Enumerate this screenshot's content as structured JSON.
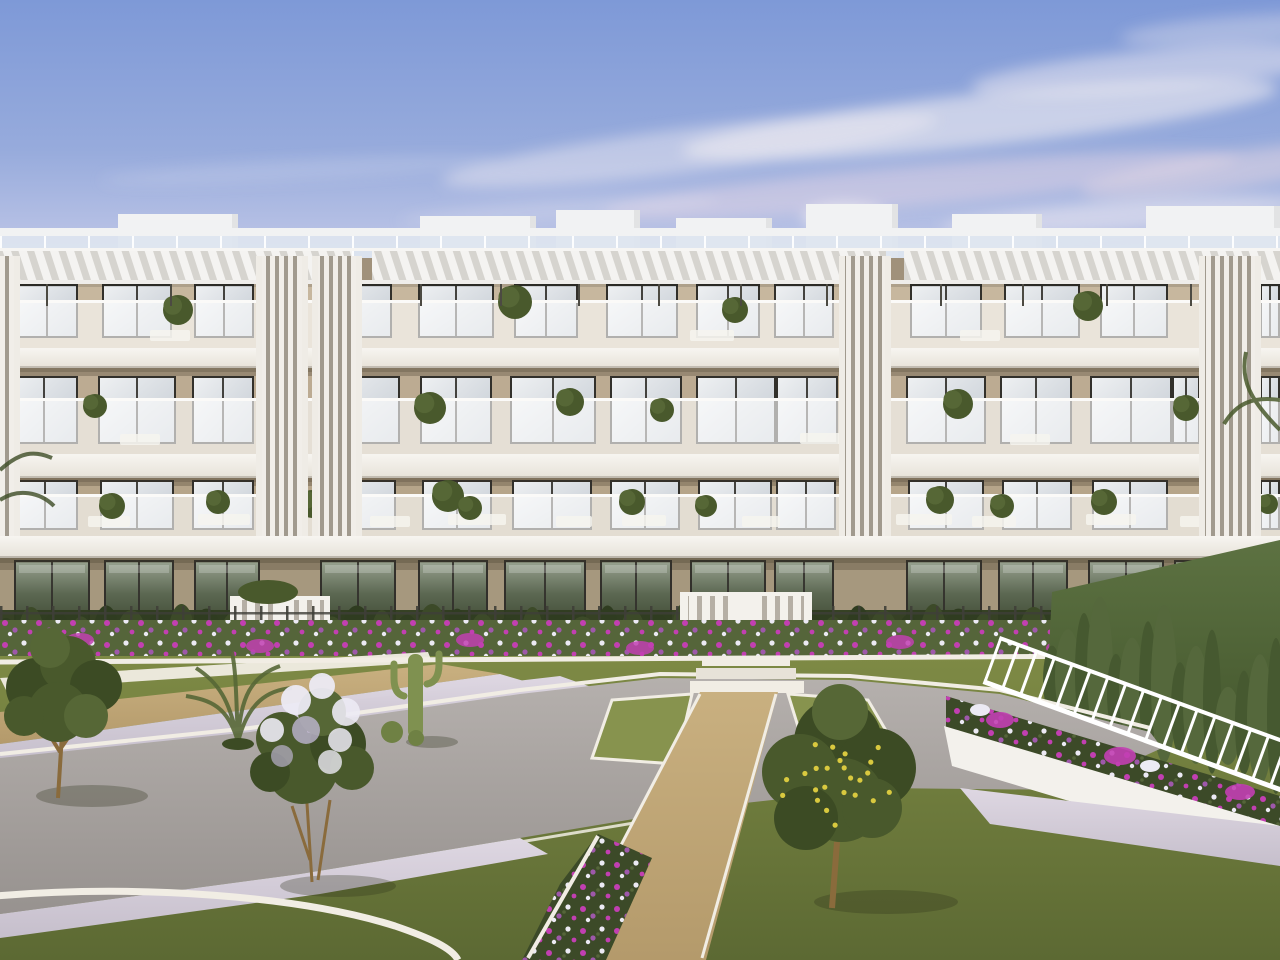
{
  "meta": {
    "alt": "Dusk 3D architectural rendering of a modern four-storey apartment building with pergola roof terraces, glass balconies and a landscaped communal garden with lawns, paths, flower beds and trees"
  },
  "colors": {
    "sky_top": "#7e99d7",
    "sky_mid": "#97abdc",
    "sky_low": "#b7c1e5",
    "sky_horizon": "#ccd2ec",
    "cloud_white": "#f0ecf2",
    "cloud_pink": "#e6d8e4",
    "parapet_white": "#f1f2f3",
    "roof_glass": "#dde5f0",
    "pergola_base": "#d6d4cf",
    "pergola_slat": "#f4f3f1",
    "pergola_beam": "#efedea",
    "wall_top": "#c7b79e",
    "wall_mid": "#bcab92",
    "wall_low": "#b6a58a",
    "wall_ground": "#a6987e",
    "band": "#f4f2ed",
    "rail": "#fbfaf8",
    "frame": "#32302b",
    "glass_hi": "#eef0f2",
    "glass_lo": "#c3cad2",
    "gglass_hi": "#97a18f",
    "gglass_lo": "#3a452f",
    "slat_dark": "#a19a8e",
    "slat_light": "#f1eee9",
    "post": "#4c4a42",
    "gate_white": "#f3f1ec",
    "gate_gap": "#b5afa5",
    "fence_dark": "#3f3f38",
    "hedge_dark": "#2f3c20",
    "hedge_mid": "#3c4a28",
    "cypress_a": "#55683c",
    "cypress_b": "#465930",
    "grass_hi": "#7e8a45",
    "grass_mid": "#6d7a3c",
    "grass_lo": "#5c6933",
    "lawn_bright": "#87934e",
    "concrete_hi": "#b5b0ad",
    "concrete_lo": "#97928f",
    "gravel_hi": "#c9b080",
    "gravel_lo": "#b49a6b",
    "pebble_hi": "#ded7e2",
    "pebble_lo": "#c6bfcc",
    "curb": "#f1ede4",
    "planter": "#f3f1ec",
    "flower_purple": "#9e58aa",
    "flower_magenta": "#c23fb2",
    "flower_white": "#eceaf4",
    "flower_green": "#55653a",
    "canopy_dark": "#3c4b24",
    "canopy_mid": "#49592c",
    "canopy_light": "#566736",
    "trunk": "#8a6b3c",
    "lemon": "#d9c93f",
    "cactus": "#7f9150",
    "cactus_dark": "#6f8144",
    "shadow": "rgba(45,50,28,0.30)"
  },
  "building": {
    "floors": [
      {
        "name": "third-floor",
        "fill": "wall_top",
        "wall_y": 258,
        "wall_h": 90,
        "top_shadow": 24,
        "win_y": 286,
        "win_h": 50,
        "windows": [
          [
            18,
            58
          ],
          [
            104,
            66
          ],
          [
            196,
            56
          ],
          [
            326,
            64
          ],
          [
            420,
            72
          ],
          [
            516,
            60
          ],
          [
            608,
            68
          ],
          [
            698,
            60
          ],
          [
            776,
            56
          ],
          [
            912,
            68
          ],
          [
            1006,
            72
          ],
          [
            1102,
            64
          ],
          [
            1262,
            16
          ]
        ]
      },
      {
        "name": "second-floor",
        "fill": "wall_mid",
        "wall_y": 368,
        "wall_h": 86,
        "top_shadow": 8,
        "win_y": 378,
        "win_h": 64,
        "windows": [
          [
            12,
            64
          ],
          [
            100,
            74
          ],
          [
            194,
            58
          ],
          [
            322,
            76
          ],
          [
            422,
            68
          ],
          [
            512,
            82
          ],
          [
            612,
            68
          ],
          [
            698,
            76
          ],
          [
            778,
            58
          ],
          [
            908,
            76
          ],
          [
            1002,
            68
          ],
          [
            1092,
            78
          ],
          [
            1174,
            24
          ],
          [
            1262,
            16
          ]
        ]
      },
      {
        "name": "first-floor",
        "fill": "wall_low",
        "wall_y": 478,
        "wall_h": 58,
        "top_shadow": 8,
        "win_y": 482,
        "win_h": 46,
        "windows": [
          [
            14,
            62
          ],
          [
            102,
            70
          ],
          [
            194,
            58
          ],
          [
            324,
            70
          ],
          [
            424,
            66
          ],
          [
            514,
            76
          ],
          [
            612,
            66
          ],
          [
            700,
            70
          ],
          [
            778,
            56
          ],
          [
            910,
            72
          ],
          [
            1004,
            66
          ],
          [
            1094,
            72
          ],
          [
            1262,
            16
          ]
        ]
      },
      {
        "name": "ground-floor",
        "fill": "wall_ground",
        "ground": true,
        "wall_y": 556,
        "wall_h": 104,
        "top_shadow": 14,
        "win_y": 562,
        "win_h": 70,
        "windows": [
          [
            16,
            72
          ],
          [
            106,
            66
          ],
          [
            196,
            62
          ],
          [
            322,
            72
          ],
          [
            420,
            66
          ],
          [
            506,
            78
          ],
          [
            602,
            68
          ],
          [
            692,
            72
          ],
          [
            776,
            56
          ],
          [
            908,
            72
          ],
          [
            1000,
            66
          ],
          [
            1090,
            72
          ],
          [
            1176,
            28
          ],
          [
            1262,
            16
          ]
        ]
      }
    ],
    "roof_boxes": [
      [
        118,
        238,
        214
      ],
      [
        420,
        536,
        216
      ],
      [
        556,
        640,
        210
      ],
      [
        676,
        772,
        218
      ],
      [
        806,
        898,
        204
      ],
      [
        952,
        1042,
        214
      ],
      [
        1146,
        1280,
        206
      ]
    ],
    "pergola_posts": [
      46,
      170,
      294,
      352,
      420,
      500,
      578,
      658,
      740,
      826,
      940,
      1022,
      1106,
      1190,
      1252
    ],
    "louver_towers": [
      [
        0,
        14
      ],
      [
        262,
        302
      ],
      [
        318,
        356
      ],
      [
        845,
        885
      ],
      [
        1205,
        1255
      ]
    ],
    "balcony_plants": [
      [
        178,
        310,
        15
      ],
      [
        515,
        302,
        17
      ],
      [
        735,
        310,
        13
      ],
      [
        1088,
        306,
        15
      ],
      [
        1244,
        312,
        13
      ],
      [
        95,
        406,
        12
      ],
      [
        430,
        408,
        16
      ],
      [
        570,
        402,
        14
      ],
      [
        662,
        410,
        12
      ],
      [
        958,
        404,
        15
      ],
      [
        1186,
        408,
        13
      ],
      [
        112,
        506,
        13
      ],
      [
        218,
        502,
        12
      ],
      [
        312,
        504,
        14
      ],
      [
        448,
        496,
        16
      ],
      [
        470,
        508,
        12
      ],
      [
        632,
        502,
        13
      ],
      [
        706,
        506,
        11
      ],
      [
        940,
        500,
        14
      ],
      [
        1002,
        506,
        12
      ],
      [
        1104,
        502,
        13
      ],
      [
        1232,
        498,
        14
      ],
      [
        1268,
        504,
        10
      ]
    ],
    "furniture": [
      [
        88,
        42,
        516
      ],
      [
        198,
        52,
        514
      ],
      [
        370,
        40,
        516
      ],
      [
        448,
        58,
        514
      ],
      [
        556,
        36,
        516
      ],
      [
        622,
        44,
        515
      ],
      [
        742,
        38,
        516
      ],
      [
        896,
        56,
        514
      ],
      [
        972,
        44,
        516
      ],
      [
        1086,
        50,
        514
      ],
      [
        1180,
        36,
        516
      ],
      [
        120,
        40,
        434
      ],
      [
        800,
        44,
        433
      ],
      [
        1010,
        40,
        434
      ],
      [
        150,
        40,
        330
      ],
      [
        690,
        44,
        330
      ],
      [
        960,
        40,
        330
      ]
    ]
  },
  "garden": {
    "hedge": {
      "x0": 6,
      "x1": 1134,
      "count": 46,
      "base_y": 652
    },
    "cypresses": {
      "x0": 1052,
      "x1": 1276,
      "count": 15,
      "base_y0": 700,
      "slope": 0.28
    },
    "lemon_count": 24
  }
}
